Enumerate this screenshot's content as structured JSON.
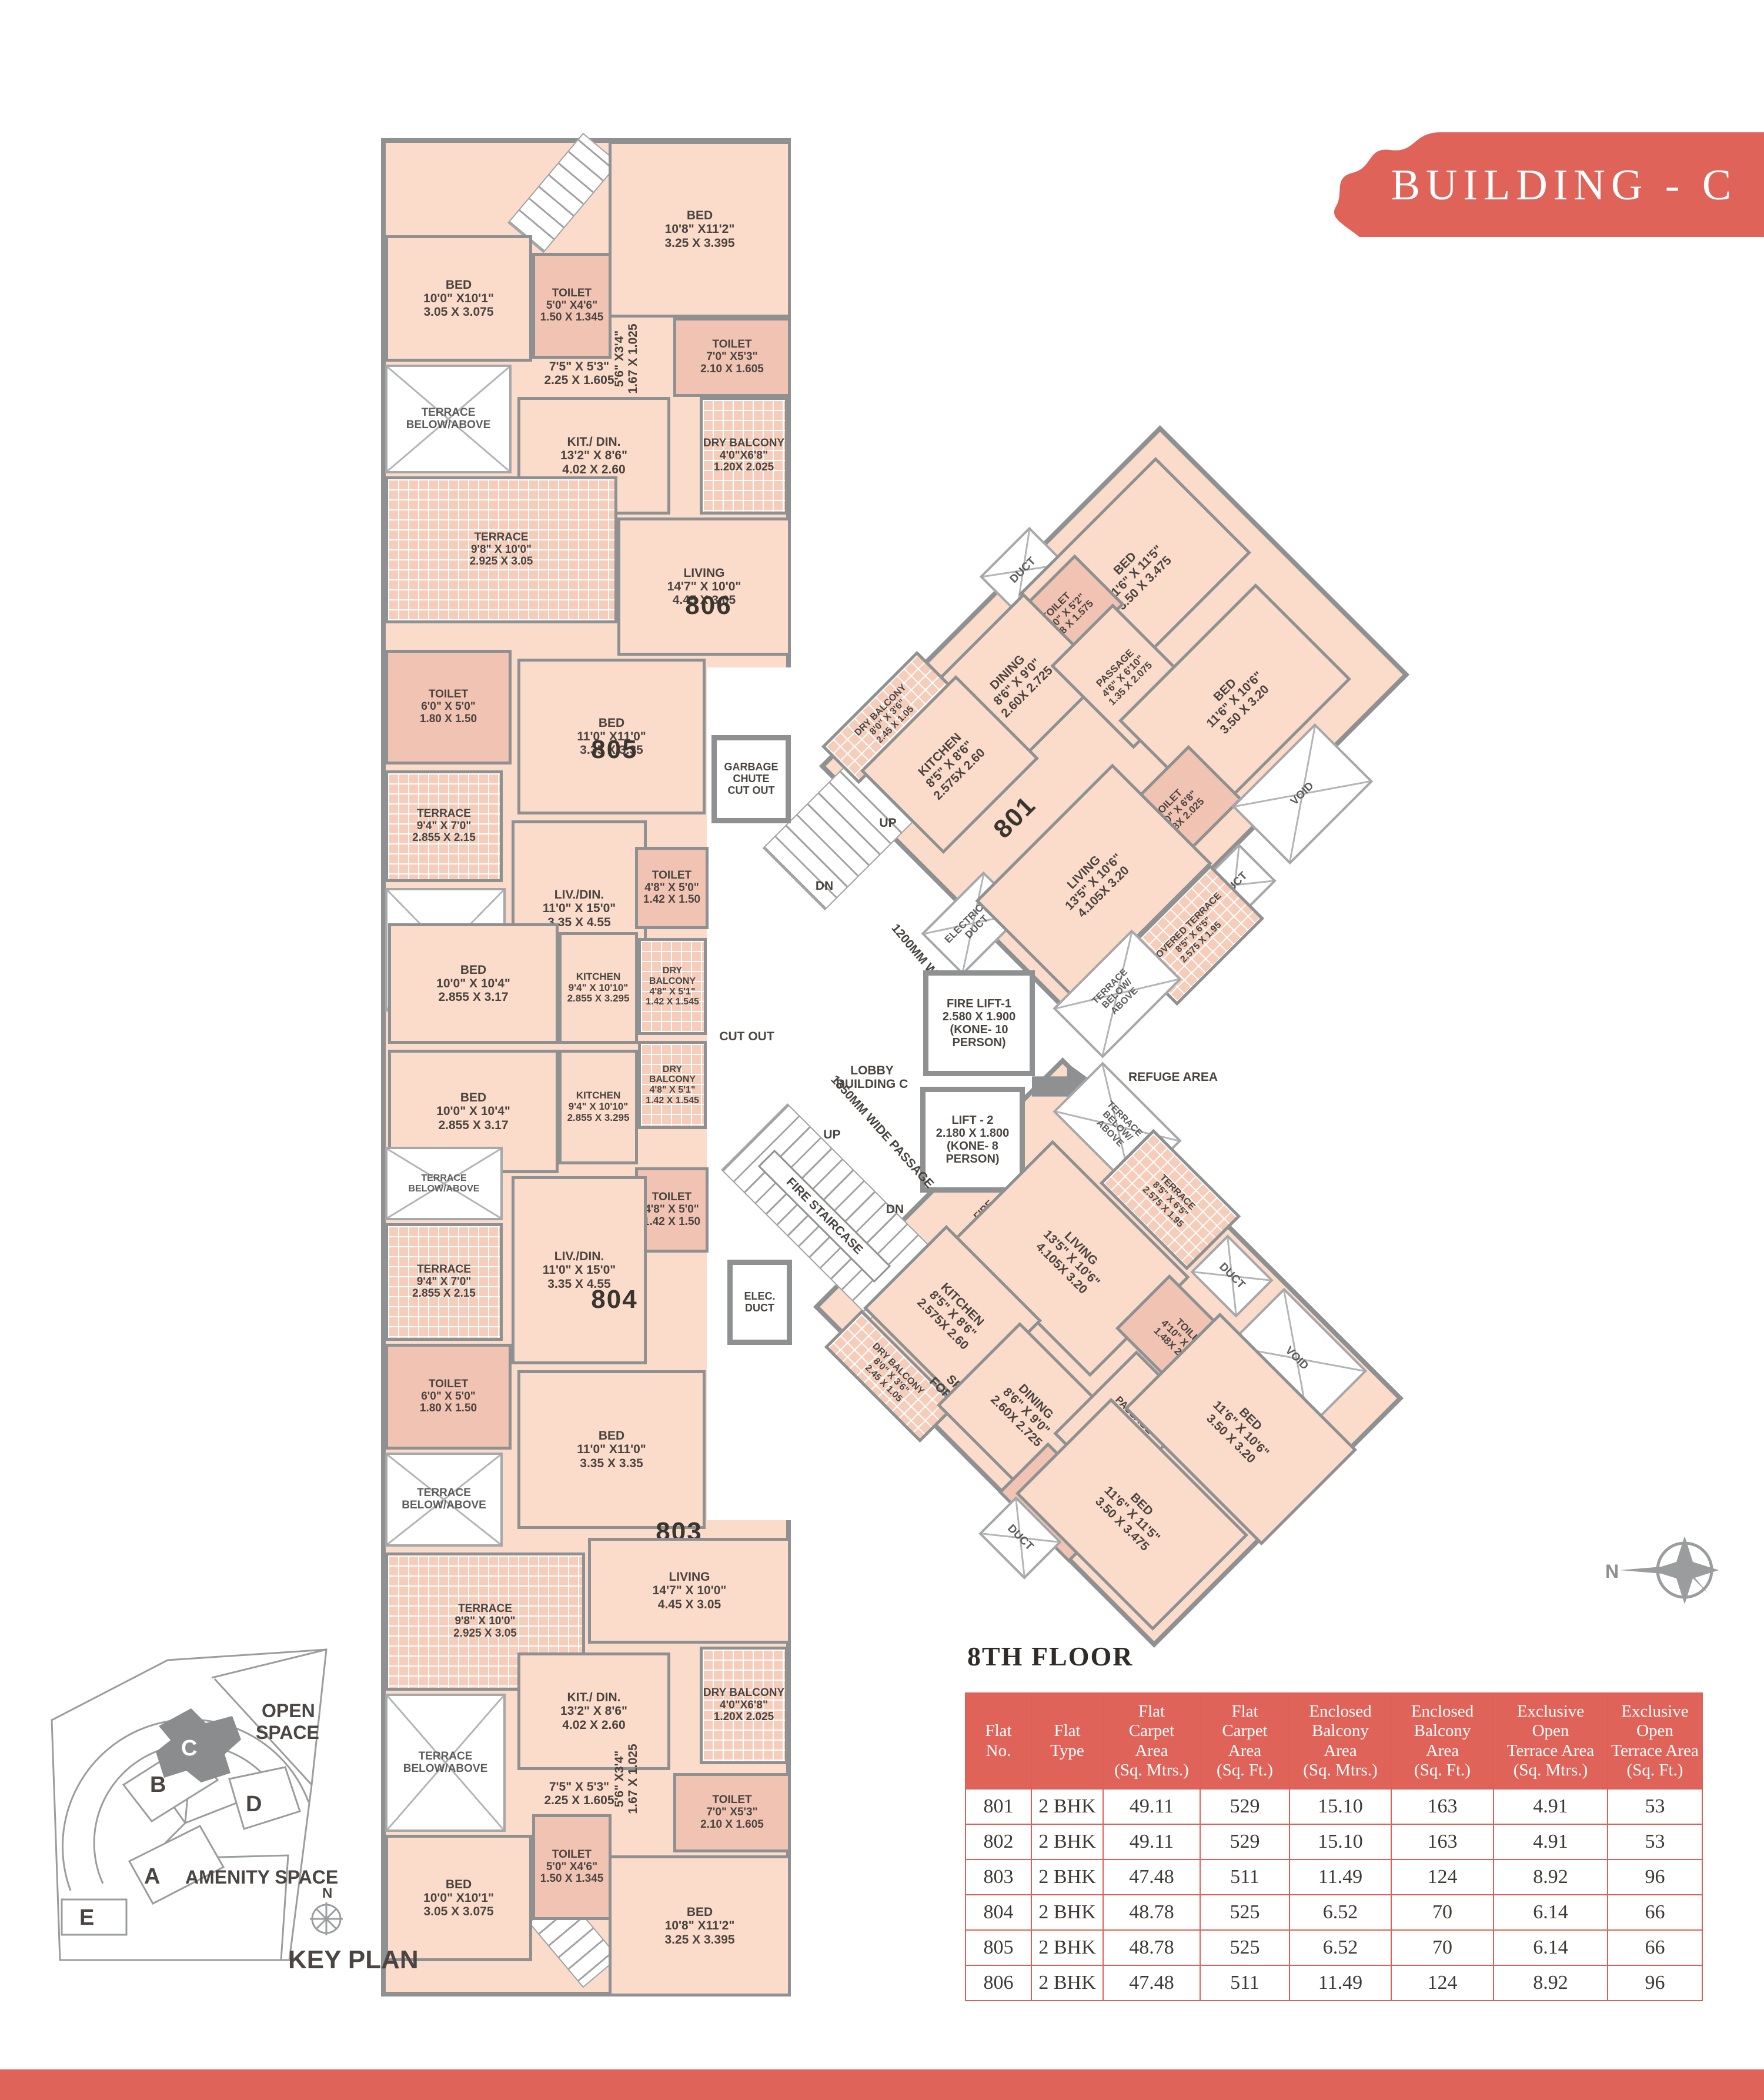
{
  "banner": {
    "title": "BUILDING - C"
  },
  "floor_heading": "8TH FLOOR",
  "compass": {
    "label": "N"
  },
  "key_plan": {
    "title": "KEY PLAN",
    "north": "N",
    "open_space": "OPEN\nSPACE",
    "amenity_space": "AMENITY SPACE",
    "buildings": [
      "A",
      "B",
      "C",
      "D",
      "E"
    ],
    "highlighted": "C"
  },
  "table": {
    "headers": [
      "Flat\nNo.",
      "Flat\nType",
      "Flat\nCarpet\nArea\n(Sq. Mtrs.)",
      "Flat\nCarpet\nArea\n(Sq. Ft.)",
      "Enclosed\nBalcony\nArea\n(Sq. Mtrs.)",
      "Enclosed\nBalcony\nArea\n(Sq. Ft.)",
      "Exclusive\nOpen\nTerrace Area\n(Sq. Mtrs.)",
      "Exclusive\nOpen\nTerrace Area\n(Sq. Ft.)"
    ],
    "rows": [
      [
        "801",
        "2 BHK",
        "49.11",
        "529",
        "15.10",
        "163",
        "4.91",
        "53"
      ],
      [
        "802",
        "2 BHK",
        "49.11",
        "529",
        "15.10",
        "163",
        "4.91",
        "53"
      ],
      [
        "803",
        "2 BHK",
        "47.48",
        "511",
        "11.49",
        "124",
        "8.92",
        "96"
      ],
      [
        "804",
        "2 BHK",
        "48.78",
        "525",
        "6.52",
        "70",
        "6.14",
        "66"
      ],
      [
        "805",
        "2 BHK",
        "48.78",
        "525",
        "6.52",
        "70",
        "6.14",
        "66"
      ],
      [
        "806",
        "2 BHK",
        "47.48",
        "511",
        "11.49",
        "124",
        "8.92",
        "96"
      ]
    ]
  },
  "plan": {
    "rooms": [
      {
        "id": "bed-806-a",
        "name": "BED",
        "d1": "10'8\" X11'2\"",
        "d2": "3.25 X 3.395"
      },
      {
        "id": "bed-806-b",
        "name": "BED",
        "d1": "10'0\" X10'1\"",
        "d2": "3.05 X 3.075"
      },
      {
        "id": "toilet-806-a",
        "name": "TOILET",
        "d1": "5'0\" X4'6\"",
        "d2": "1.50 X 1.345"
      },
      {
        "id": "lbl-806-pass",
        "name": "7'5\" X 5'3\"",
        "d1": "2.25 X 1.605"
      },
      {
        "id": "lbl-806-niche",
        "name": "5'6\" X3'4\"",
        "d1": "1.67 X 1.025"
      },
      {
        "id": "toilet-806-b",
        "name": "TOILET",
        "d1": "7'0\" X5'3\"",
        "d2": "2.10 X 1.605"
      },
      {
        "id": "terrace-ba-1",
        "name": "TERRACE\nBELOW/ABOVE"
      },
      {
        "id": "kitdin-806",
        "name": "KIT./ DIN.",
        "d1": "13'2\" X 8'6\"",
        "d2": "4.02 X 2.60"
      },
      {
        "id": "drybalc-806",
        "name": "DRY BALCONY",
        "d1": "4'0\"X6'8\"",
        "d2": "1.20X 2.025"
      },
      {
        "id": "terrace-806",
        "name": "TERRACE",
        "d1": "9'8\" X 10'0\"",
        "d2": "2.925 X 3.05"
      },
      {
        "id": "living-806",
        "name": "LIVING",
        "d1": "14'7\" X 10'0\"",
        "d2": "4.45 X 3.05"
      },
      {
        "id": "unit-806",
        "name": "806"
      },
      {
        "id": "bed-806-c",
        "name": "BED",
        "d1": "11'0\" X11'0\"",
        "d2": "3.35 X 3.35"
      },
      {
        "id": "toilet-805-a",
        "name": "TOILET",
        "d1": "6'0\" X 5'0\"",
        "d2": "1.80 X 1.50"
      },
      {
        "id": "unit-805",
        "name": "805"
      },
      {
        "id": "terrace-805",
        "name": "TERRACE",
        "d1": "9'4\" X 7'0\"",
        "d2": "2.855 X 2.15"
      },
      {
        "id": "livdin-805",
        "name": "LIV./DIN.",
        "d1": "11'0\" X 15'0\"",
        "d2": "3.35 X 4.55"
      },
      {
        "id": "terrace-ba-2",
        "name": "TERRACE\nBELOW/ABOVE"
      },
      {
        "id": "toilet-805-b",
        "name": "TOILET",
        "d1": "4'8\" X 5'0\"",
        "d2": "1.42 X 1.50"
      },
      {
        "id": "bed-805",
        "name": "BED",
        "d1": "10'0\" X 10'4\"",
        "d2": "2.855 X 3.17"
      },
      {
        "id": "kitchen-805",
        "name": "KITCHEN",
        "d1": "9'4\" X 10'10\"",
        "d2": "2.855 X 3.295"
      },
      {
        "id": "drybalc-805",
        "name": "DRY BALCONY",
        "d1": "4'8\" X 5'1\"",
        "d2": "1.42 X 1.545"
      },
      {
        "id": "bed-804",
        "name": "BED",
        "d1": "10'0\" X 10'4\"",
        "d2": "2.855 X 3.17"
      },
      {
        "id": "kitchen-804",
        "name": "KITCHEN",
        "d1": "9'4\" X 10'10\"",
        "d2": "2.855 X 3.295"
      },
      {
        "id": "drybalc-804",
        "name": "DRY BALCONY",
        "d1": "4'8\" X 5'1\"",
        "d2": "1.42 X 1.545"
      },
      {
        "id": "toilet-804-a",
        "name": "TOILET",
        "d1": "4'8\" X 5'0\"",
        "d2": "1.42 X 1.50"
      },
      {
        "id": "terrace-ba-3",
        "name": "TERRACE\nBELOW/ABOVE"
      },
      {
        "id": "livdin-804",
        "name": "LIV./DIN.",
        "d1": "11'0\" X 15'0\"",
        "d2": "3.35 X 4.55"
      },
      {
        "id": "unit-804",
        "name": "804"
      },
      {
        "id": "terrace-804",
        "name": "TERRACE",
        "d1": "9'4\" X 7'0\"",
        "d2": "2.855 X 2.15"
      },
      {
        "id": "toilet-804-b",
        "name": "TOILET",
        "d1": "6'0\" X 5'0\"",
        "d2": "1.80 X 1.50"
      },
      {
        "id": "bed-804-b",
        "name": "BED",
        "d1": "11'0\" X11'0\"",
        "d2": "3.35 X 3.35"
      },
      {
        "id": "terrace-ba-4",
        "name": "TERRACE\nBELOW/ABOVE"
      },
      {
        "id": "unit-803",
        "name": "803"
      },
      {
        "id": "living-803",
        "name": "LIVING",
        "d1": "14'7\" X 10'0\"",
        "d2": "4.45 X 3.05"
      },
      {
        "id": "terrace-803",
        "name": "TERRACE",
        "d1": "9'8\" X 10'0\"",
        "d2": "2.925 X 3.05"
      },
      {
        "id": "drybalc-803",
        "name": "DRY BALCONY",
        "d1": "4'0\"X6'8\"",
        "d2": "1.20X 2.025"
      },
      {
        "id": "kitdin-803",
        "name": "KIT./ DIN.",
        "d1": "13'2\" X 8'6\"",
        "d2": "4.02 X 2.60"
      },
      {
        "id": "terrace-ba-5",
        "name": "TERRACE\nBELOW/ABOVE"
      },
      {
        "id": "lbl-803-pass",
        "name": "7'5\" X 5'3\"",
        "d1": "2.25 X 1.605"
      },
      {
        "id": "lbl-803-niche",
        "name": "5'6\" X3'4\"",
        "d1": "1.67 X 1.025"
      },
      {
        "id": "toilet-803-a",
        "name": "TOILET",
        "d1": "7'0\" X5'3\"",
        "d2": "2.10 X 1.605"
      },
      {
        "id": "bed-803-a",
        "name": "BED",
        "d1": "10'0\" X10'1\"",
        "d2": "3.05 X 3.075"
      },
      {
        "id": "toilet-803-b",
        "name": "TOILET",
        "d1": "5'0\" X4'6\"",
        "d2": "1.50 X 1.345"
      },
      {
        "id": "bed-803-b",
        "name": "BED",
        "d1": "10'8\" X11'2\"",
        "d2": "3.25 X 3.395"
      },
      {
        "id": "garbage-chute",
        "name": "GARBAGE\nCHUTE\nCUT OUT"
      },
      {
        "id": "lbl-cutout",
        "name": "CUT OUT"
      },
      {
        "id": "lbl-passage-1200",
        "name": "1200MM WIDE PASSAGE"
      },
      {
        "id": "lbl-up-1",
        "name": "UP"
      },
      {
        "id": "lbl-dn-1",
        "name": "DN"
      },
      {
        "id": "electrical-duct",
        "name": "ELECTRICAL\nDUCT"
      },
      {
        "id": "fire-lift-1",
        "name": "FIRE LIFT-1",
        "d1": "2.580 X 1.900",
        "d2": "(KONE- 10 PERSON)"
      },
      {
        "id": "lift-2",
        "name": "LIFT - 2",
        "d1": "2.180 X 1.800",
        "d2": "(KONE- 8 PERSON)"
      },
      {
        "id": "lbl-lobby",
        "name": "LOBBY\nBUILDING C"
      },
      {
        "id": "lbl-refuge",
        "name": "REFUGE AREA"
      },
      {
        "id": "lbl-firehose",
        "name": "FIRE\nHOSE/EL DUCT"
      },
      {
        "id": "lbl-passage-1350",
        "name": "1350MM WIDE PASSAGE"
      },
      {
        "id": "fire-staircase",
        "name": "FIRE STAIRCASE"
      },
      {
        "id": "lbl-up-2",
        "name": "UP"
      },
      {
        "id": "lbl-dn-2",
        "name": "DN"
      },
      {
        "id": "elec-duct",
        "name": "ELEC.\nDUCT"
      },
      {
        "id": "duct-801-a",
        "name": "DUCT"
      },
      {
        "id": "bed-801-a",
        "name": "BED",
        "d1": "11'6\" X 11'5\"",
        "d2": "3.50 X 3.475"
      },
      {
        "id": "toilet-801-a",
        "name": "TOILET",
        "d1": "4'10\" X 5'2\"",
        "d2": "1.48 X 1.575"
      },
      {
        "id": "dining-801",
        "name": "DINING",
        "d1": "8'6\" X 9'0\"",
        "d2": "2.60X 2.725"
      },
      {
        "id": "drybalc-801",
        "name": "DRY BALCONY",
        "d1": "8'0\" X 3'6\"",
        "d2": "2.45 X 1.05"
      },
      {
        "id": "kitchen-801",
        "name": "KITCHEN",
        "d1": "8'5\" X 8'6\"",
        "d2": "2.575X 2.60"
      },
      {
        "id": "passage-801",
        "name": "PASSAGE",
        "d1": "4'6\" X 6'10\"",
        "d2": "1.35 X 2.075"
      },
      {
        "id": "bed-801-b",
        "name": "BED",
        "d1": "11'6\" X 10'6\"",
        "d2": "3.50 X 3.20"
      },
      {
        "id": "toilet-801-b",
        "name": "TOILET",
        "d1": "4'10\" X 6'8\"",
        "d2": "1.48X 2.025"
      },
      {
        "id": "void-801",
        "name": "VOID"
      },
      {
        "id": "duct-801-b",
        "name": "DUCT"
      },
      {
        "id": "living-801",
        "name": "LIVING",
        "d1": "13'5\" X 10'6\"",
        "d2": "4.105X 3.20"
      },
      {
        "id": "unit-801",
        "name": "801"
      },
      {
        "id": "covterr-801",
        "name": "COVERED TERRACE",
        "d1": "8'5\" X 6'5\"",
        "d2": "2.575 X 1.95"
      },
      {
        "id": "terrace-ba-801",
        "name": "TERRACE\nBELOW/\nABOVE"
      },
      {
        "id": "terrace-ba-802",
        "name": "TERRACE\nBELOW/\nABOVE"
      },
      {
        "id": "terrace-802",
        "name": "TERRACE",
        "d1": "8'5\" X 6'5\"",
        "d2": "2.575 X 1.95"
      },
      {
        "id": "unit-802",
        "name": "802"
      },
      {
        "id": "living-802",
        "name": "LIVING",
        "d1": "13'5\" X 10'6\"",
        "d2": "4.105X 3.20"
      },
      {
        "id": "duct-802-a",
        "name": "DUCT"
      },
      {
        "id": "kitchen-802",
        "name": "KITCHEN",
        "d1": "8'5\" X 8'6\"",
        "d2": "2.575X 2.60"
      },
      {
        "id": "drybalc-802",
        "name": "DRY BALCONY",
        "d1": "8'0\" X 3'6\"",
        "d2": "2.45 X 1.05"
      },
      {
        "id": "puja-802",
        "name": "SPACE\nFOR PUJA"
      },
      {
        "id": "dining-802",
        "name": "DINING",
        "d1": "8'6\" X 9'0\"",
        "d2": "2.60X 2.725"
      },
      {
        "id": "toilet-802-a",
        "name": "TOILET",
        "d1": "4'10\" X 5'2\"",
        "d2": "1.48 X 1.575"
      },
      {
        "id": "passage-802",
        "name": "PASSAGE",
        "d1": "4'6\" X 6'10\"",
        "d2": "1.35 X 2.075"
      },
      {
        "id": "toilet-802-b",
        "name": "TOILET",
        "d1": "4'10\" X 6'8\"",
        "d2": "1.48X 2.025"
      },
      {
        "id": "void-802",
        "name": "VOID"
      },
      {
        "id": "bed-802-a",
        "name": "BED",
        "d1": "11'6\" X 10'6\"",
        "d2": "3.50 X 3.20"
      },
      {
        "id": "bed-802-b",
        "name": "BED",
        "d1": "11'6\" X 11'5\"",
        "d2": "3.50 X 3.475"
      },
      {
        "id": "duct-802-b",
        "name": "DUCT"
      }
    ]
  }
}
